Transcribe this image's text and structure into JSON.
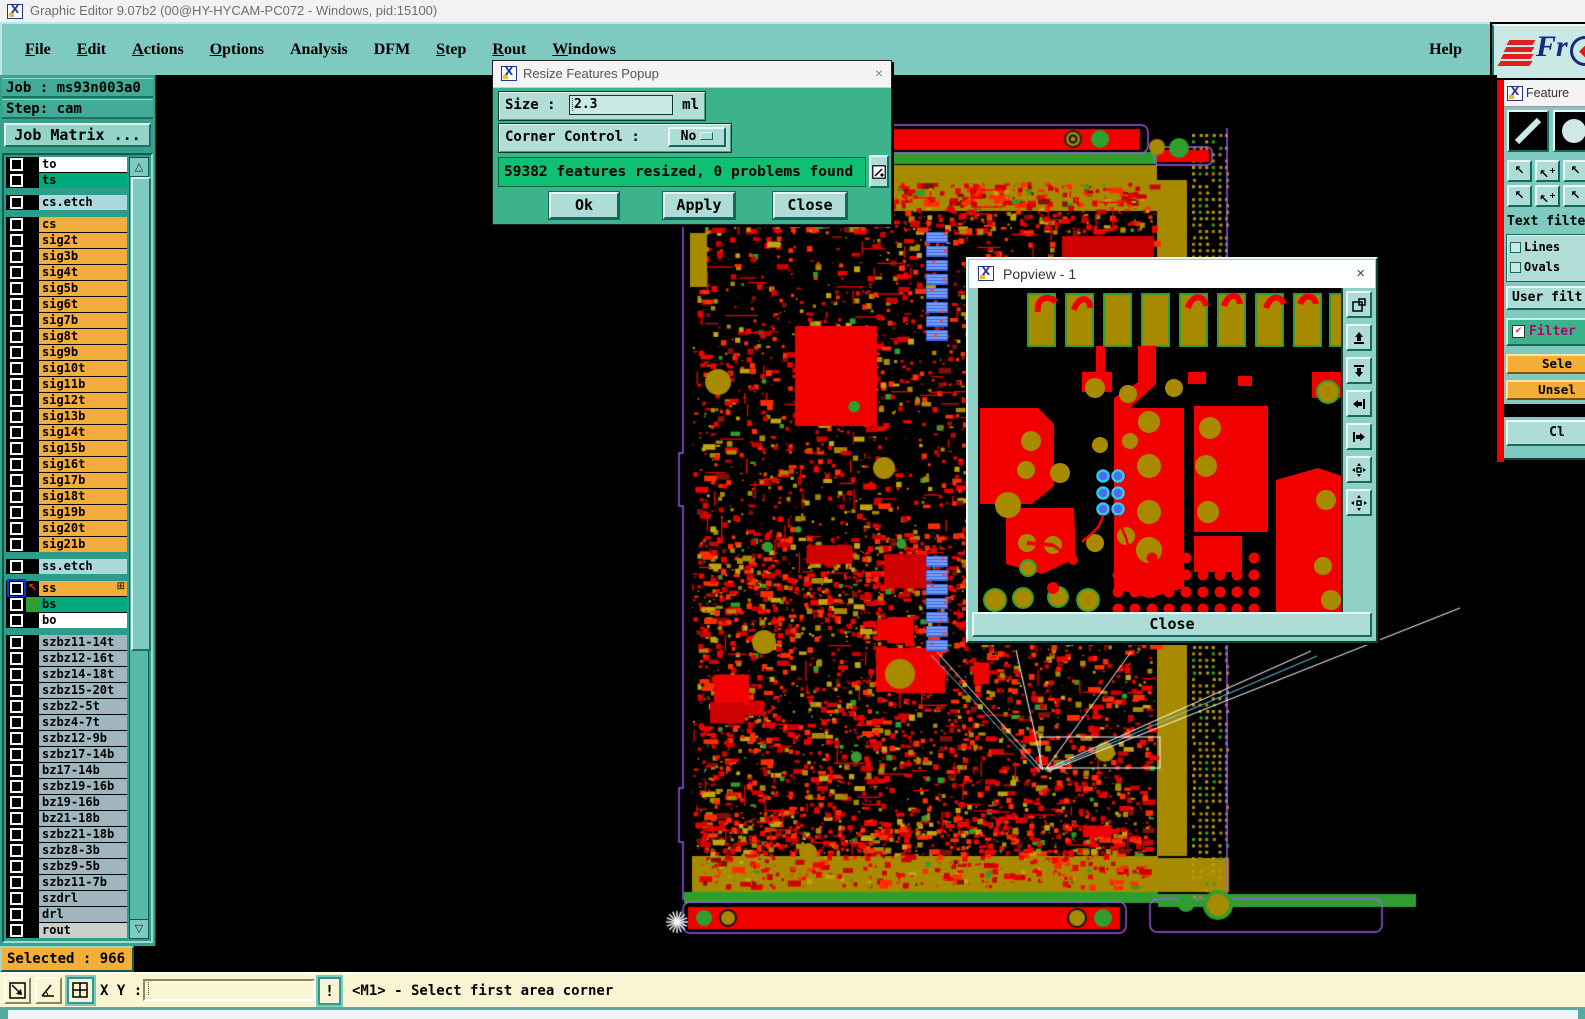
{
  "window": {
    "title": "Graphic Editor 9.07b2 (00@HY-HYCAM-PC072 - Windows, pid:15100)"
  },
  "menu": {
    "items": [
      {
        "label": "File",
        "mnemonic": 0
      },
      {
        "label": "Edit",
        "mnemonic": 0
      },
      {
        "label": "Actions",
        "mnemonic": 0
      },
      {
        "label": "Options",
        "mnemonic": 0
      },
      {
        "label": "Analysis",
        "mnemonic": -1
      },
      {
        "label": "DFM",
        "mnemonic": -1
      },
      {
        "label": "Step",
        "mnemonic": 0
      },
      {
        "label": "Rout",
        "mnemonic": 0
      },
      {
        "label": "Windows",
        "mnemonic": 0
      }
    ],
    "help_label": "Help"
  },
  "logo": {
    "text": "Fr"
  },
  "sidebar": {
    "job_label": "Job : ms93n003a0",
    "step_label": "Step: cam",
    "job_matrix_button": "Job Matrix ...",
    "selected_label": "Selected : 966",
    "layer_groups": [
      {
        "rows": [
          {
            "name": "to",
            "bg": "#ffffff"
          },
          {
            "name": "ts",
            "bg": "#00a87b"
          }
        ]
      },
      {
        "rows": [
          {
            "name": "cs.etch",
            "bg": "#abd9dc"
          }
        ]
      },
      {
        "rows": [
          {
            "name": "cs",
            "bg": "#f2ad3c"
          },
          {
            "name": "sig2t",
            "bg": "#f2ad3c"
          },
          {
            "name": "sig3b",
            "bg": "#f2ad3c"
          },
          {
            "name": "sig4t",
            "bg": "#f2ad3c"
          },
          {
            "name": "sig5b",
            "bg": "#f2ad3c"
          },
          {
            "name": "sig6t",
            "bg": "#f2ad3c"
          },
          {
            "name": "sig7b",
            "bg": "#f2ad3c"
          },
          {
            "name": "sig8t",
            "bg": "#f2ad3c"
          },
          {
            "name": "sig9b",
            "bg": "#f2ad3c"
          },
          {
            "name": "sig10t",
            "bg": "#f2ad3c"
          },
          {
            "name": "sig11b",
            "bg": "#f2ad3c"
          },
          {
            "name": "sig12t",
            "bg": "#f2ad3c"
          },
          {
            "name": "sig13b",
            "bg": "#f2ad3c"
          },
          {
            "name": "sig14t",
            "bg": "#f2ad3c"
          },
          {
            "name": "sig15b",
            "bg": "#f2ad3c"
          },
          {
            "name": "sig16t",
            "bg": "#f2ad3c"
          },
          {
            "name": "sig17b",
            "bg": "#f2ad3c"
          },
          {
            "name": "sig18t",
            "bg": "#f2ad3c"
          },
          {
            "name": "sig19b",
            "bg": "#f2ad3c"
          },
          {
            "name": "sig20t",
            "bg": "#f2ad3c"
          },
          {
            "name": "sig21b",
            "bg": "#f2ad3c"
          }
        ]
      },
      {
        "rows": [
          {
            "name": "ss.etch",
            "bg": "#abd9dc"
          }
        ]
      },
      {
        "rows": [
          {
            "name": "ss",
            "bg": "#f2ad3c",
            "special": "active"
          },
          {
            "name": "bs",
            "bg": "#00a87b",
            "special": "swatch"
          },
          {
            "name": "bo",
            "bg": "#ffffff"
          }
        ]
      },
      {
        "rows": [
          {
            "name": "szbz11-14t",
            "bg": "#9fb6be"
          },
          {
            "name": "szbz12-16t",
            "bg": "#9fb6be"
          },
          {
            "name": "szbz14-18t",
            "bg": "#9fb6be"
          },
          {
            "name": "szbz15-20t",
            "bg": "#9fb6be"
          },
          {
            "name": "szbz2-5t",
            "bg": "#9fb6be"
          },
          {
            "name": "szbz4-7t",
            "bg": "#9fb6be"
          },
          {
            "name": "szbz12-9b",
            "bg": "#9fb6be"
          },
          {
            "name": "szbz17-14b",
            "bg": "#9fb6be"
          },
          {
            "name": "bz17-14b",
            "bg": "#9fb6be"
          },
          {
            "name": "szbz19-16b",
            "bg": "#9fb6be"
          },
          {
            "name": "bz19-16b",
            "bg": "#9fb6be"
          },
          {
            "name": "bz21-18b",
            "bg": "#9fb6be"
          },
          {
            "name": "szbz21-18b",
            "bg": "#9fb6be"
          },
          {
            "name": "szbz8-3b",
            "bg": "#9fb6be"
          },
          {
            "name": "szbz9-5b",
            "bg": "#9fb6be"
          },
          {
            "name": "szbz11-7b",
            "bg": "#9fb6be"
          },
          {
            "name": "szdrl",
            "bg": "#9fb6be"
          },
          {
            "name": "drl",
            "bg": "#9fb6be"
          },
          {
            "name": "rout",
            "bg": "#c9cfc9"
          }
        ]
      }
    ]
  },
  "dialog": {
    "title": "Resize Features Popup",
    "size_label": "Size :",
    "size_value": "2.3",
    "size_unit": "ml",
    "corner_label": "Corner Control :",
    "corner_value": "No",
    "message": "59382 features resized, 0 problems found",
    "ok_button": "Ok",
    "apply_button": "Apply",
    "close_button": "Close",
    "close_x": "×"
  },
  "popview": {
    "title": "Popview - 1",
    "close_button": "Close",
    "close_x": "×"
  },
  "right_panel": {
    "title": "Feature",
    "text_filter_label": "Text filte",
    "lines_label": "Lines",
    "ovals_label": "Ovals",
    "user_filter_button": "User filt",
    "filter_label": "Filter",
    "filter_check": "✔",
    "select_button": "Sele",
    "unselect_button": "Unsel",
    "close_button": "Cl"
  },
  "bottom": {
    "xy_label": "X Y :",
    "xy_value": "",
    "alert_button": "!",
    "status": "<M1> - Select first area corner"
  },
  "colors": {
    "teal_panel": "#7fcac0",
    "sidebar_teal": "#35a28e",
    "dialog_green": "#3db38b",
    "message_green": "#0fbf72",
    "widget_teal": "#aedcd6",
    "orange": "#f3ae38",
    "cream": "#f9f5d2",
    "copper_red": "#f20000",
    "pad_olive": "#a88a00",
    "board_green": "#2f9e2f",
    "outline_purple": "#a05ef2",
    "select_blue": "#4a6ee8",
    "accent_red": "#f20000"
  }
}
